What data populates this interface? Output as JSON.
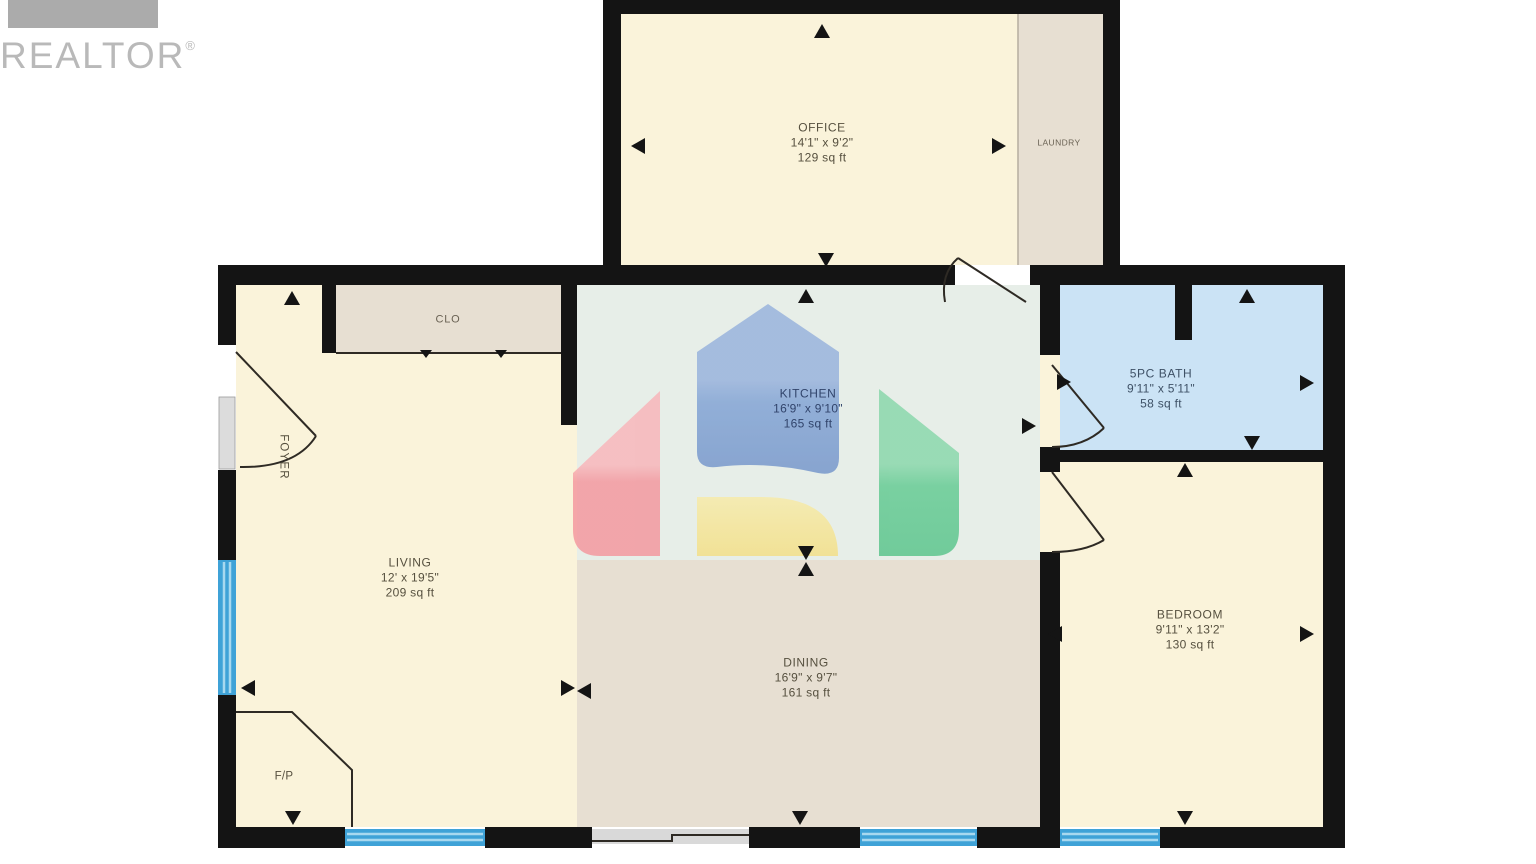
{
  "branding": {
    "logo_text": "REALTOR",
    "registered_mark": "®"
  },
  "rooms": {
    "office": {
      "name": "OFFICE",
      "dims": "14'1\" x 9'2\"",
      "area": "129 sq ft"
    },
    "laundry": {
      "name": "LAUNDRY"
    },
    "closet": {
      "name": "CLO"
    },
    "foyer": {
      "name": "FOYER"
    },
    "kitchen": {
      "name": "KITCHEN",
      "dims": "16'9\" x 9'10\"",
      "area": "165 sq ft"
    },
    "bath": {
      "name": "5PC BATH",
      "dims": "9'11\" x 5'11\"",
      "area": "58 sq ft"
    },
    "living": {
      "name": "LIVING",
      "dims": "12' x 19'5\"",
      "area": "209 sq ft"
    },
    "dining": {
      "name": "DINING",
      "dims": "16'9\" x 9'7\"",
      "area": "161 sq ft"
    },
    "bedroom": {
      "name": "BEDROOM",
      "dims": "9'11\" x 13'2\"",
      "area": "130 sq ft"
    },
    "fireplace": {
      "name": "F/P"
    }
  },
  "colors": {
    "wall": "#141414",
    "room_cream": "#faf3da",
    "room_tan": "#e7dfd2",
    "kitchen_green": "#e7eee8",
    "bath_blue": "#cbe3f5",
    "window_blue": "#3fa2d7",
    "window_stripe": "#a8d8ef",
    "slider_gray": "#d9d9d9",
    "sidelight_gray": "#dcdcdc",
    "door_line": "#2e2a24",
    "label_dark": "#56503f",
    "label_navy": "#31446b",
    "label_bath": "#3e5166",
    "logo_gray": "#b9b9b9",
    "logo_bar": "#ababab",
    "wm_red": "#f4939b",
    "wm_blue": "#7da0d4",
    "wm_yellow": "#f5e28a",
    "wm_green": "#5ec98f"
  }
}
